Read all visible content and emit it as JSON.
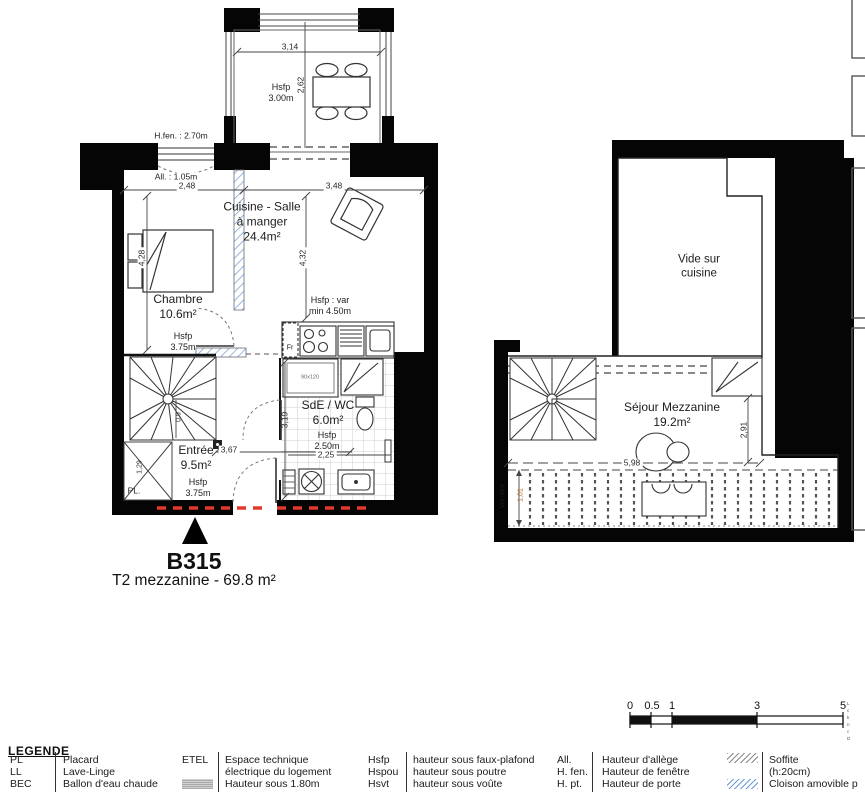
{
  "plan_title": {
    "unit": "B315",
    "type": "T2 mezzanine - 69.8 m²"
  },
  "level1": {
    "terrace_hsfp": "Hsfp\n3.00m",
    "dim_terrace_w": "3,14",
    "dim_terrace_h": "2,62",
    "hfen": "H.fen. : 2.70m",
    "allege": "All. : 1.05m",
    "dim_chambre_w": "2,48",
    "dim_cuisine_w": "3,48",
    "dim_chambre_h": "4,28",
    "dim_cuisine_h": "4,32",
    "chambre": "Chambre\n10.6m²",
    "chambre_hsfp": "Hsfp\n3.75m",
    "cuisine": "Cuisine - Salle\nà manger\n24.4m²",
    "cuisine_hsfp": "Hsfp : var\nmin 4.50m",
    "fr": "Fr",
    "sde": "SdE / WC\n6.0m²",
    "sde_hsfp": "Hsfp\n2.50m",
    "dim_sde_w": "2,25",
    "dim_sde_h": "3,19",
    "shower": "90x120",
    "entree": "Entrée\n9.5m²",
    "entree_hsfp": "Hsfp\n3.75m",
    "dim_entree": "3,67",
    "dim_hall": "0,9",
    "dim_placard": "1,29",
    "pl": "PL."
  },
  "level2": {
    "vide": "Vide sur\ncuisine",
    "sejour": "Séjour Mezzanine\n19.2m²",
    "dim_w": "5,98",
    "dim_h": "2,91",
    "verriere": "Verrière",
    "verriere_dim": "1,01"
  },
  "scalebar": {
    "t0": "0",
    "t05": "0.5",
    "t1": "1",
    "t3": "3",
    "t5": "5"
  },
  "legend": {
    "title": "LEGENDE",
    "colA": [
      {
        "abbr": "PL",
        "label": "Placard"
      },
      {
        "abbr": "LL",
        "label": "Lave-Linge"
      },
      {
        "abbr": "BEC",
        "label": "Ballon d'eau chaude"
      }
    ],
    "colB": {
      "abbr": "ETEL",
      "line1": "Espace technique",
      "line2": "électrique du logement",
      "h180": "Hauteur sous 1.80m"
    },
    "colC": [
      {
        "abbr": "Hsfp",
        "label": "hauteur sous faux-plafond"
      },
      {
        "abbr": "Hspou",
        "label": "hauteur sous poutre"
      },
      {
        "abbr": "Hsvt",
        "label": "hauteur sous voûte"
      }
    ],
    "colD": [
      {
        "abbr": "All.",
        "label": "Hauteur d'allège"
      },
      {
        "abbr": "H. fen.",
        "label": "Hauteur de fenêtre"
      },
      {
        "abbr": "H. pt.",
        "label": "Hauteur de porte"
      }
    ],
    "colE": {
      "soffite": "Soffite\n(h:20cm)",
      "cloison": "Cloison amovible p"
    }
  },
  "edge_text": "L\nc\nk\nn\nc\nD",
  "colors": {
    "partition_blue": "#6b9bd2",
    "demolition_red": "#e03a2f",
    "dim_orange": "#b96a28"
  }
}
